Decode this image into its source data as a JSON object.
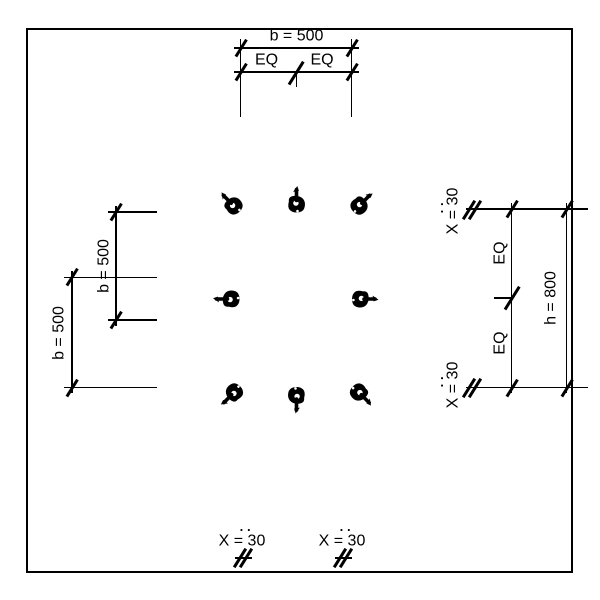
{
  "drawing": {
    "type": "column-section-rebar-layout",
    "colors": {
      "line": "#000000",
      "background": "#ffffff"
    }
  },
  "labels": {
    "top": {
      "width": "b = 500",
      "eq_left": "EQ",
      "eq_right": "EQ"
    },
    "left": {
      "inner_width": "b = 500",
      "outer_width": "b = 500"
    },
    "right": {
      "eq_top": "EQ",
      "eq_bottom": "EQ",
      "height": "h = 800",
      "offset_top": "X = 30",
      "offset_bottom": "X = 30"
    },
    "bottom": {
      "offset_left": "X = 30",
      "offset_right": "X = 30"
    },
    "dots": "··"
  },
  "bars": [
    {
      "id": "top-left",
      "x": 234,
      "y": 206,
      "hook_angle": -45
    },
    {
      "id": "top-middle",
      "x": 296.5,
      "y": 204.5,
      "hook_angle": 0
    },
    {
      "id": "top-right",
      "x": 359,
      "y": 206,
      "hook_angle": 45
    },
    {
      "id": "middle-left",
      "x": 231.5,
      "y": 299,
      "hook_angle": -90
    },
    {
      "id": "middle-right",
      "x": 360,
      "y": 299,
      "hook_angle": 90
    },
    {
      "id": "bottom-left",
      "x": 234.5,
      "y": 392,
      "hook_angle": -135
    },
    {
      "id": "bottom-middle",
      "x": 296.5,
      "y": 395,
      "hook_angle": 180
    },
    {
      "id": "bottom-right",
      "x": 358.5,
      "y": 392,
      "hook_angle": 135
    }
  ]
}
